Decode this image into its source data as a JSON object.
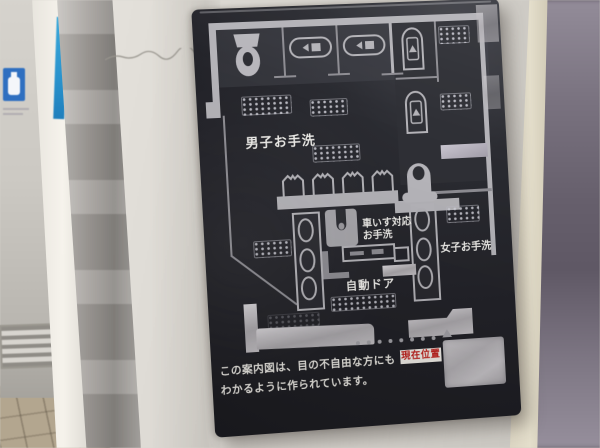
{
  "colors": {
    "sign-bg": "#232329",
    "silver": "#b4b3b8",
    "accent-red": "#c0231f",
    "badge-bg": "#f0ede7",
    "blue-sign": "#2f6fc0",
    "blue-stripe": "#2f9fd4",
    "note-text": "#eceae4"
  },
  "sign": {
    "map_labels": {
      "mens": "男子お手洗",
      "wheelchair_line1": "車いす対応",
      "wheelchair_line2": "お手洗",
      "womens": "女子お手洗",
      "auto_door": "自動ドア"
    },
    "current_location": "現在位置",
    "note": {
      "line1": "この案内図は、目の不自由な方にも",
      "line2": "わかるように作られています。"
    }
  }
}
